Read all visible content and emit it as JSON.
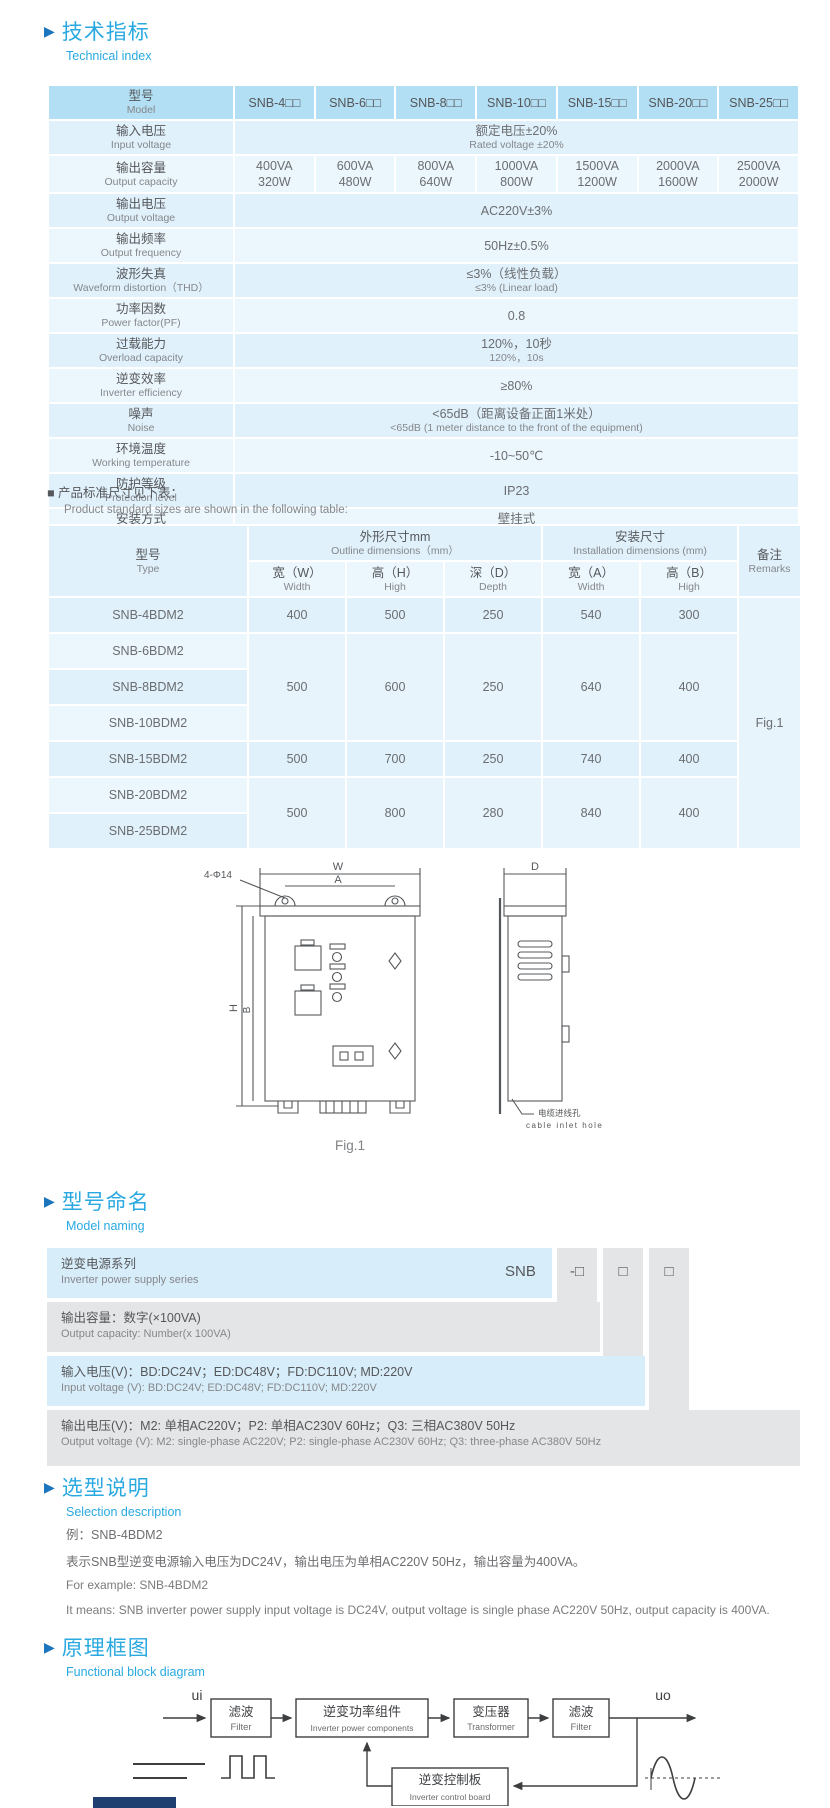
{
  "sec_technical": {
    "title_zh": "技术指标",
    "title_en": "Technical index"
  },
  "sec_naming": {
    "title_zh": "型号命名",
    "title_en": "Model naming"
  },
  "sec_selection": {
    "title_zh": "选型说明",
    "title_en": "Selection description"
  },
  "sec_block": {
    "title_zh": "原理框图",
    "title_en": "Functional block diagram"
  },
  "spec_table": {
    "model_label_zh": "型号",
    "model_label_en": "Model",
    "models": [
      "SNB-4□□",
      "SNB-6□□",
      "SNB-8□□",
      "SNB-10□□",
      "SNB-15□□",
      "SNB-20□□",
      "SNB-25□□"
    ],
    "rows": {
      "input_voltage": {
        "zh": "输入电压",
        "en": "Input voltage",
        "val_zh": "额定电压±20%",
        "val_en": "Rated voltage ±20%"
      },
      "output_capacity": {
        "zh": "输出容量",
        "en": "Output capacity",
        "va": [
          "400VA",
          "600VA",
          "800VA",
          "1000VA",
          "1500VA",
          "2000VA",
          "2500VA"
        ],
        "w": [
          "320W",
          "480W",
          "640W",
          "800W",
          "1200W",
          "1600W",
          "2000W"
        ]
      },
      "output_voltage": {
        "zh": "输出电压",
        "en": "Output voltage",
        "val": "AC220V±3%"
      },
      "output_frequency": {
        "zh": "输出频率",
        "en": "Output frequency",
        "val": "50Hz±0.5%"
      },
      "waveform": {
        "zh": "波形失真",
        "en": "Waveform distortion（THD）",
        "val_zh": "≤3%（线性负载）",
        "val_en": "≤3% (Linear load)"
      },
      "power_factor": {
        "zh": "功率因数",
        "en": "Power factor(PF)",
        "val": "0.8"
      },
      "overload": {
        "zh": "过载能力",
        "en": "Overload capacity",
        "val_zh": "120%，10秒",
        "val_en": "120%，10s"
      },
      "efficiency": {
        "zh": "逆变效率",
        "en": "Inverter efficiency",
        "val": "≥80%"
      },
      "noise": {
        "zh": "噪声",
        "en": "Noise",
        "val_zh": "<65dB（距离设备正面1米处）",
        "val_en": "<65dB (1 meter distance to the front of the equipment)"
      },
      "temperature": {
        "zh": "环境温度",
        "en": "Working temperature",
        "val": "-10~50℃"
      },
      "protection": {
        "zh": "防护等级",
        "en": "Protection level",
        "val": "IP23"
      },
      "installation": {
        "zh": "安装方式",
        "en": "Installation",
        "val_zh": "壁挂式",
        "val_en": "Wall-mounted"
      }
    }
  },
  "size_note": {
    "zh": "■ 产品标准尺寸见下表：",
    "en": "Product standard sizes are shown in the following table:"
  },
  "size_table": {
    "type_zh": "型号",
    "type_en": "Type",
    "outline_zh": "外形尺寸mm",
    "outline_en": "Outline dimensions（mm）",
    "install_zh": "安装尺寸",
    "install_en": "Installation dimensions (mm)",
    "remarks_zh": "备注",
    "remarks_en": "Remarks",
    "col_w_zh": "宽（W）",
    "col_w_en": "Width",
    "col_h_zh": "高（H）",
    "col_h_en": "High",
    "col_d_zh": "深（D）",
    "col_d_en": "Depth",
    "col_a_zh": "宽（A）",
    "col_a_en": "Width",
    "col_b_zh": "高（B）",
    "col_b_en": "High",
    "models": [
      "SNB-4BDM2",
      "SNB-6BDM2",
      "SNB-8BDM2",
      "SNB-10BDM2",
      "SNB-15BDM2",
      "SNB-20BDM2",
      "SNB-25BDM2"
    ],
    "groups": [
      {
        "w": "400",
        "h": "500",
        "d": "250",
        "a": "540",
        "b": "300"
      },
      {
        "w": "500",
        "h": "600",
        "d": "250",
        "a": "640",
        "b": "400"
      },
      {
        "w": "500",
        "h": "700",
        "d": "250",
        "a": "740",
        "b": "400"
      },
      {
        "w": "500",
        "h": "800",
        "d": "280",
        "a": "840",
        "b": "400"
      }
    ],
    "remark": "Fig.1"
  },
  "figure": {
    "dim_w": "W",
    "dim_a": "A",
    "dim_d": "D",
    "dim_h": "H",
    "dim_b": "B",
    "holes_label": "4-Φ14",
    "cable_zh": "电缆进线孔",
    "cable_en": "cable inlet hole",
    "caption": "Fig.1"
  },
  "naming": {
    "prefix": "SNB",
    "box1": "-□",
    "box2": "□",
    "box3": "□",
    "rows": [
      {
        "zh": "逆变电源系列",
        "en": "Inverter power supply series"
      },
      {
        "zh": "输出容量：数字(×100VA)",
        "en": "Output capacity: Number(x 100VA)"
      },
      {
        "zh": "输入电压(V)：BD:DC24V；ED:DC48V；FD:DC110V; MD:220V",
        "en": "Input voltage (V): BD:DC24V;  ED:DC48V;  FD:DC110V; MD:220V"
      },
      {
        "zh": "输出电压(V)：M2: 单相AC220V；P2: 单相AC230V 60Hz；Q3: 三相AC380V 50Hz",
        "en": "Output voltage (V):  M2: single-phase AC220V;  P2: single-phase AC230V 60Hz;  Q3: three-phase AC380V 50Hz"
      }
    ]
  },
  "selection": {
    "example_zh": "例：SNB-4BDM2",
    "desc_zh": "表示SNB型逆变电源输入电压为DC24V，输出电压为单相AC220V 50Hz，输出容量为400VA。",
    "example_en": "For example: SNB-4BDM2",
    "desc_en": "It means: SNB inverter power supply input voltage is DC24V, output voltage is single phase AC220V 50Hz, output capacity is 400VA."
  },
  "block_diagram": {
    "input": "ui",
    "output": "uo",
    "filter1_zh": "滤波",
    "filter1_en": "Filter",
    "inverter_zh": "逆变功率组件",
    "inverter_en": "Inverter power components",
    "transformer_zh": "变压器",
    "transformer_en": "Transformer",
    "filter2_zh": "滤波",
    "filter2_en": "Filter",
    "control_zh": "逆变控制板",
    "control_en": "Inverter control board"
  }
}
